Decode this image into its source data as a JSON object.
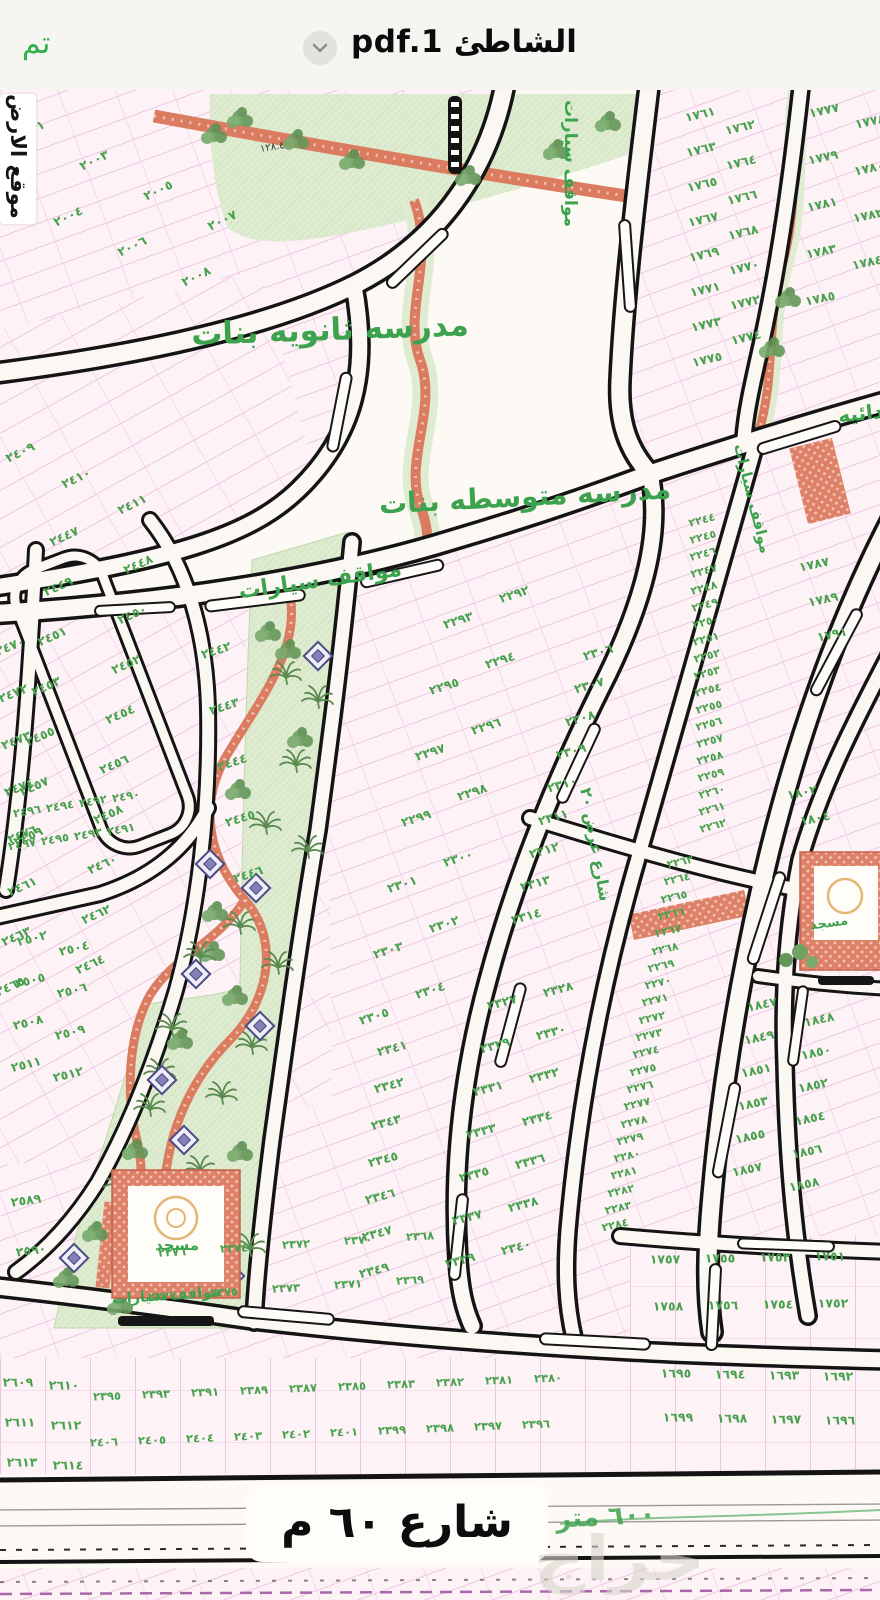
{
  "header": {
    "done_label": "تم",
    "title": "الشاطئ pdf.1",
    "chevron_icon": "chevron-down"
  },
  "map": {
    "labels": {
      "school_secondary": "مدرسه ثانويه بنات",
      "school_middle": "مدرسه متوسطه بنات",
      "school_primary_partial": "ابتدائيه",
      "parking": "مواقف سيارات",
      "mosque": "مسجد",
      "site_location": "موقع الارض",
      "street_60": "شارع ٦٠ م",
      "street_60_green": "٦٠٠ متر",
      "street_width_20": "شارع عرض ٢٠",
      "dim_128": "١٢٨.٤",
      "watermark": "حراج"
    },
    "colors": {
      "accent_green": "#2fb14c",
      "label_green": "#3ca24e",
      "plot_number_green": "#48a14d",
      "plot_line_pink": "#e5aed9",
      "road_black": "#141414",
      "red_path": "#db7c61",
      "park_green": "#dfecd2",
      "paper": "#faf5f0"
    },
    "blocks": [
      {
        "name": "block-2001-2008",
        "numbers": [
          "٢٠٠١",
          "٢٠٠٣",
          "٢٠٠٥",
          "٢٠٠٧",
          "٢٠٠٢",
          "٢٠٠٤",
          "٢٠٠٦",
          "٢٠٠٨"
        ]
      },
      {
        "name": "block-2409-2411",
        "numbers": [
          "٢٤٠٩",
          "٢٤١٠",
          "٢٤١١"
        ]
      },
      {
        "name": "block-2447-2465",
        "numbers": [
          "٢٤٤٧",
          "٢٤٤٨",
          "٢٤٤٩",
          "٢٤٥٠",
          "٢٤٥١",
          "٢٤٥٢",
          "٢٤٥٣",
          "٢٤٥٤",
          "٢٤٥٥",
          "٢٤٥٦",
          "٢٤٥٧",
          "٢٤٥٨",
          "٢٤٥٩",
          "٢٤٦٠",
          "٢٤٦١",
          "٢٤٦٢",
          "٢٤٦٣",
          "٢٤٦٤",
          "٢٤٦٥"
        ]
      },
      {
        "name": "block-2470-2476",
        "numbers": [
          "٢٤٧٠",
          "٢٤٧٢",
          "٢٤٧٣",
          "٢٤٧٤",
          "٢٤٧٦"
        ]
      },
      {
        "name": "block-2442-2446",
        "numbers": [
          "٢٤٤٢",
          "٢٤٤٣",
          "٢٤٤٤",
          "٢٤٤٥",
          "٢٤٤٦"
        ]
      },
      {
        "name": "block-2490-2497",
        "numbers": [
          "٢٤٩٠",
          "٢٤٩٢",
          "٢٤٩٤",
          "٢٤٩٦",
          "٢٤٩١",
          "٢٤٩٣",
          "٢٤٩٥",
          "٢٤٩٧"
        ]
      },
      {
        "name": "block-2502-2512",
        "numbers": [
          "٢٥٠٢",
          "٢٥٠٤",
          "٢٥٠٥",
          "٢٥٠٦",
          "٢٥٠٨",
          "٢٥٠٩",
          "٢٥١١",
          "٢٥١٢"
        ]
      },
      {
        "name": "block-2589-2590",
        "numbers": [
          "٢٥٨٩",
          "٢٥٩٠"
        ]
      },
      {
        "name": "block-2609-2614",
        "numbers": [
          "٢٦٠٩",
          "٢٦١٠",
          "٢٦١١",
          "٢٦١٢",
          "٢٦١٣",
          "٢٦١٤"
        ]
      },
      {
        "name": "block-2292-2305",
        "numbers": [
          "٢٢٩٢",
          "٢٢٩٣",
          "٢٢٩٤",
          "٢٢٩٥",
          "٢٢٩٦",
          "٢٢٩٧",
          "٢٢٩٨",
          "٢٢٩٩",
          "٢٣٠٠",
          "٢٣٠١",
          "٢٣٠٢",
          "٢٣٠٣",
          "٢٣٠٤",
          "٢٣٠٥"
        ]
      },
      {
        "name": "block-2306-2314",
        "numbers": [
          "٢٣٠٦",
          "٢٣٠٧",
          "٢٣٠٨",
          "٢٣٠٩",
          "٢٣١٠",
          "٢٣١١",
          "٢٣١٢",
          "٢٣١٣",
          "٢٣١٤"
        ]
      },
      {
        "name": "block-2327-2340",
        "numbers": [
          "٢٣٢٧",
          "٢٣٢٨",
          "٢٣٢٩",
          "٢٣٣٠",
          "٢٣٣١",
          "٢٣٣٢",
          "٢٣٣٣",
          "٢٣٣٤",
          "٢٣٣٥",
          "٢٣٣٦",
          "٢٣٣٧",
          "٢٣٣٨",
          "٢٣٣٩",
          "٢٣٤٠"
        ]
      },
      {
        "name": "block-2341-2349",
        "numbers": [
          "٢٣٤١",
          "٢٣٤٢",
          "٢٣٤٣",
          "٢٣٤٥",
          "٢٣٤٦",
          "٢٣٤٧",
          "٢٣٤٩"
        ]
      },
      {
        "name": "block-2244-2262",
        "numbers": [
          "٢٢٤٤",
          "٢٢٤٥",
          "٢٢٤٦",
          "٢٢٤٧",
          "٢٢٤٨",
          "٢٢٤٩",
          "٢٢٥٠",
          "٢٢٥١",
          "٢٢٥٢",
          "٢٢٥٣",
          "٢٢٥٤",
          "٢٢٥٥",
          "٢٢٥٦",
          "٢٢٥٧",
          "٢٢٥٨",
          "٢٢٥٩",
          "٢٢٦٠",
          "٢٢٦١",
          "٢٢٦٢"
        ]
      },
      {
        "name": "block-2263-2284",
        "numbers": [
          "٢٢٦٣",
          "٢٢٦٤",
          "٢٢٦٥",
          "٢٢٦٦",
          "٢٢٦٧",
          "٢٢٦٨",
          "٢٢٦٩",
          "٢٢٧٠",
          "٢٢٧١",
          "٢٢٧٢",
          "٢٢٧٣",
          "٢٢٧٤",
          "٢٢٧٥",
          "٢٢٧٦",
          "٢٢٧٧",
          "٢٢٧٨",
          "٢٢٧٩",
          "٢٢٨٠",
          "٢٢٨١",
          "٢٢٨٢",
          "٢٢٨٣",
          "٢٢٨٤"
        ]
      },
      {
        "name": "block-1761-1775",
        "numbers": [
          "١٧٦١",
          "١٧٦٢",
          "١٧٦٣",
          "١٧٦٤",
          "١٧٦٥",
          "١٧٦٦",
          "١٧٦٧",
          "١٧٦٨",
          "١٧٦٩",
          "١٧٧٠",
          "١٧٧١",
          "١٧٧٢",
          "١٧٧٣",
          "١٧٧٤",
          "١٧٧٥"
        ]
      },
      {
        "name": "block-1777-1785",
        "numbers": [
          "١٧٧٧",
          "١٧٧٨",
          "١٧٧٩",
          "١٧٨٠",
          "١٧٨١",
          "١٧٨٢",
          "١٧٨٣",
          "١٧٨٤",
          "١٧٨٥"
        ]
      },
      {
        "name": "block-1787-1791",
        "numbers": [
          "١٧٨٧",
          "١٧٨٩",
          "١٧٩١"
        ]
      },
      {
        "name": "block-1802-1804",
        "numbers": [
          "١٨٠٢",
          "١٨٠٤"
        ]
      },
      {
        "name": "block-1847-1858",
        "numbers": [
          "١٨٤٧",
          "١٨٤٨",
          "١٨٤٩",
          "١٨٥٠",
          "١٨٥١",
          "١٨٥٢",
          "١٨٥٣",
          "١٨٥٤",
          "١٨٥٥",
          "١٨٥٦",
          "١٨٥٧",
          "١٨٥٨"
        ]
      },
      {
        "name": "block-1751-1758",
        "numbers": [
          "١٧٥١",
          "١٧٥٣",
          "١٧٥٥",
          "١٧٥٧",
          "١٧٥٢",
          "١٧٥٤",
          "١٧٥٦",
          "١٧٥٨"
        ]
      },
      {
        "name": "block-1692-1699",
        "numbers": [
          "١٦٩٢",
          "١٦٩٣",
          "١٦٩٤",
          "١٦٩٥",
          "١٦٩٦",
          "١٦٩٧",
          "١٦٩٨",
          "١٦٩٩"
        ]
      },
      {
        "name": "block-bottom-row-1",
        "numbers": [
          "٢٣٨٠",
          "٢٣٨١",
          "٢٣٨٢",
          "٢٣٨٣",
          "٢٣٨٥",
          "٢٣٨٧",
          "٢٣٨٩",
          "٢٣٩١",
          "٢٣٩٣",
          "٢٣٩٥"
        ]
      },
      {
        "name": "block-bottom-row-2",
        "numbers": [
          "٢٣٩٦",
          "٢٣٩٧",
          "٢٣٩٨",
          "٢٣٩٩",
          "٢٤٠١",
          "٢٤٠٢",
          "٢٤٠٣",
          "٢٤٠٤",
          "٢٤٠٥",
          "٢٤٠٦"
        ]
      },
      {
        "name": "block-2368-2377",
        "numbers": [
          "٢٣٦٨",
          "٢٣٧٠",
          "٢٣٧٢",
          "٢٣٧٤",
          "٢٣٧٦",
          "٢٣٦٩",
          "٢٣٧١",
          "٢٣٧٣",
          "٢٣٧٥",
          "٢٣٧٧"
        ]
      }
    ]
  }
}
